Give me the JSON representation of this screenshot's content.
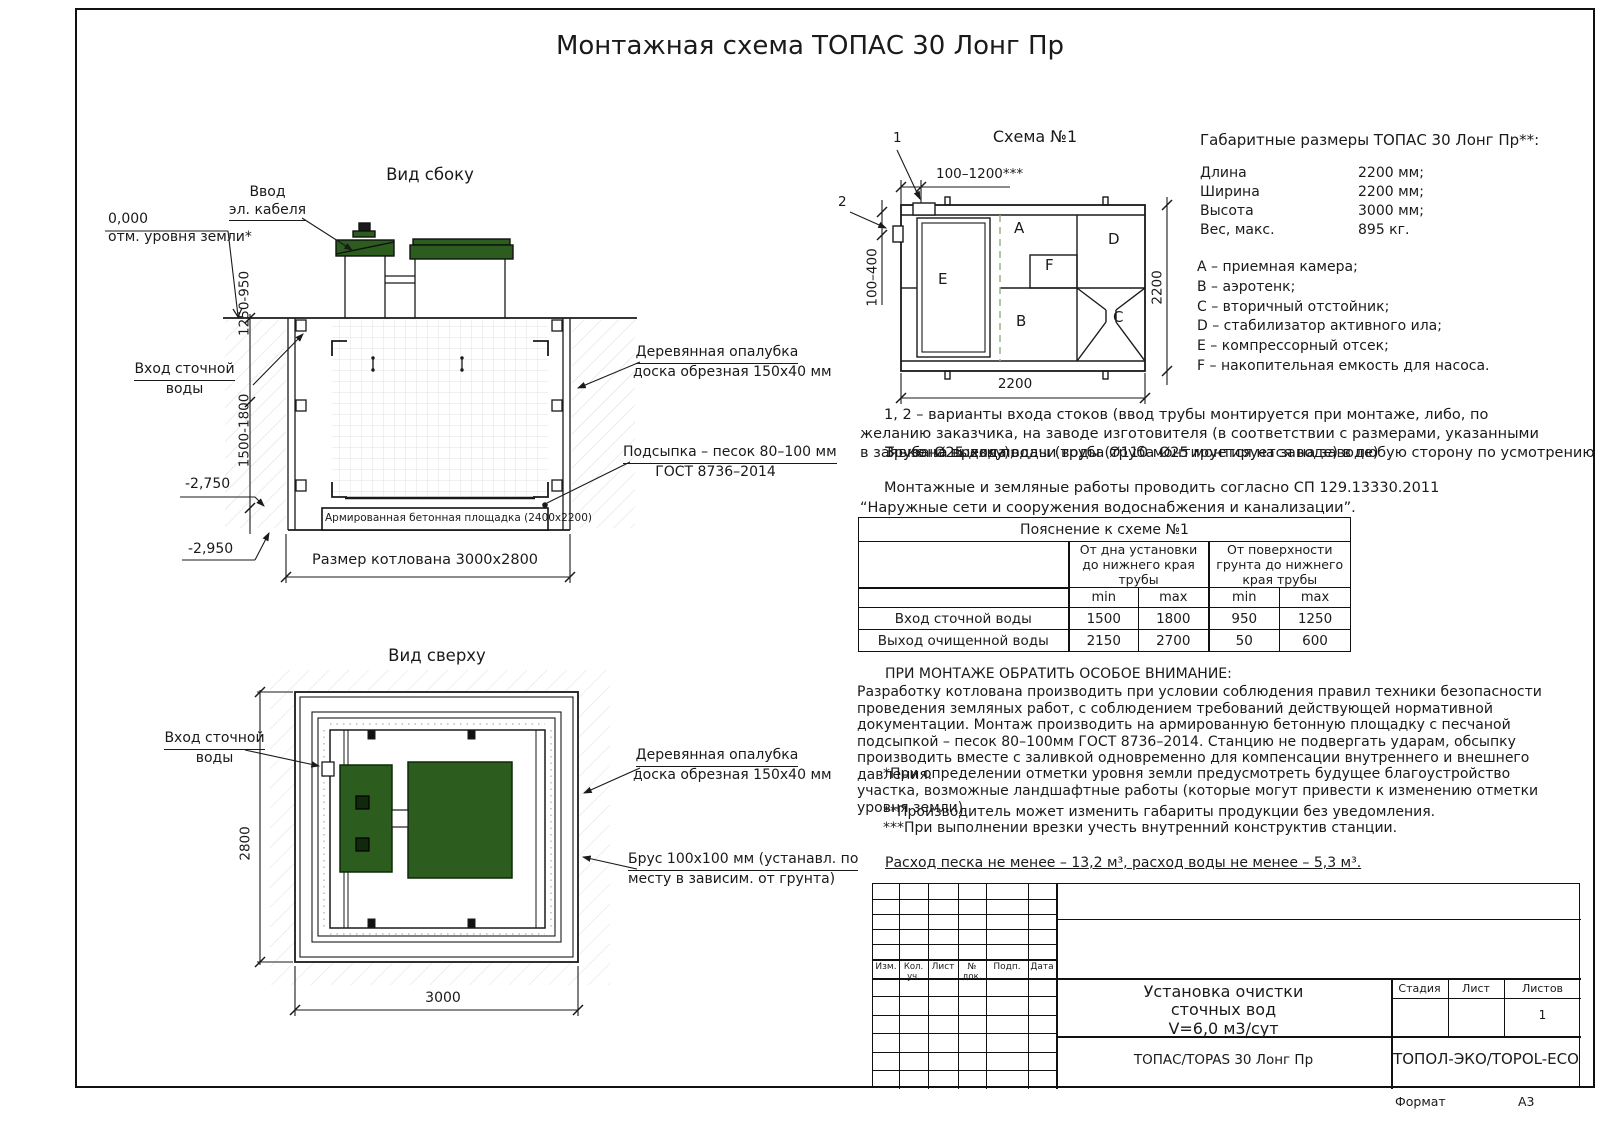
{
  "page": {
    "title": "Монтажная схема ТОПАС 30 Лонг Пр",
    "format_label": "Формат",
    "format_value": "А3"
  },
  "side_view": {
    "title": "Вид сбоку",
    "cable_1": "Ввод",
    "cable_2": "эл. кабеля",
    "zero": "0,000",
    "zero_sub": "отм. уровня земли*",
    "inlet_1": "Вход сточной",
    "inlet_2": "воды",
    "formwork_1": "Деревянная опалубка",
    "formwork_2": "доска обрезная 150х40 мм",
    "bedding_1": "Подсыпка – песок 80–100 мм",
    "bedding_2": "ГОСТ 8736–2014",
    "slab": "Армированная бетонная площадка (2400х2200)",
    "pit_size": "Размер котлована 3000х2800",
    "dim_upper": "1250-950",
    "dim_lower": "1500-1800",
    "level_1": "-2,750",
    "level_2": "-2,950"
  },
  "top_view": {
    "title": "Вид сверху",
    "inlet_1": "Вход сточной",
    "inlet_2": "воды",
    "formwork_1": "Деревянная опалубка",
    "formwork_2": "доска обрезная 150х40 мм",
    "beam_1": "Брус 100х100 мм (устанавл. по",
    "beam_2": "месту в зависим. от грунта)",
    "dim_width": "2800",
    "dim_length": "3000"
  },
  "schema": {
    "title": "Схема №1",
    "marker_1": "1",
    "marker_2": "2",
    "dim_top": "100–1200***",
    "dim_left": "100–400",
    "dim_bottom": "2200",
    "dim_right": "2200",
    "chamber_a": "A",
    "chamber_b": "B",
    "chamber_c": "C",
    "chamber_d": "D",
    "chamber_e": "E",
    "chamber_f": "F"
  },
  "overall": {
    "heading": "Габаритные размеры ТОПАС 30 Лонг Пр**:",
    "rows": [
      {
        "label": "Длина",
        "value": "2200 мм;"
      },
      {
        "label": "Ширина",
        "value": "2200 мм;"
      },
      {
        "label": "Высота",
        "value": "3000 мм;"
      },
      {
        "label": "Вес, макс.",
        "value": "895 кг."
      }
    ],
    "legend": [
      "A – приемная камера;",
      "B – аэротенк;",
      "C – вторичный отстойник;",
      "D – стабилизатор активного ила;",
      "E – компрессорный отсек;",
      "F – накопительная емкость для насоса."
    ]
  },
  "notes": {
    "variants": "1, 2 – варианты входа  стоков (ввод трубы монтируется при монтаже, либо, по желанию заказчика, на заводе изготовителя (в соответствии с размерами, указанными в заявке на врезку);",
    "overlap_a": "3 – зона выхода воды (труба Ø110 монтируется на заводе) в любую сторону по усмотрению заказчика.",
    "overlap_b": "Труба Ø25 для подачи воды (труба Ø25 монтируется на заводе)",
    "works": "Монтажные и земляные работы проводить согласно СП 129.13330.2011 “Наружные сети и сооружения водоснабжения и канализации”."
  },
  "expl_table": {
    "title": "Пояснение к схеме №1",
    "group_1": "От дна установки до нижнего края трубы",
    "group_2": "От поверхности грунта до нижнего края трубы",
    "min_1": "min",
    "max_1": "max",
    "min_2": "min",
    "max_2": "max",
    "rows": [
      {
        "label": "Вход сточной воды",
        "v": [
          "1500",
          "1800",
          "950",
          "1250"
        ]
      },
      {
        "label": "Выход очищенной воды",
        "v": [
          "2150",
          "2700",
          "50",
          "600"
        ]
      }
    ]
  },
  "warning": {
    "heading": "ПРИ МОНТАЖЕ ОБРАТИТЬ ОСОБОЕ ВНИМАНИЕ:",
    "body": "Разработку котлована производить при условии соблюдения правил техники безопасности проведения земляных работ, с соблюдением требований действующей нормативной документации.  Монтаж производить на армированную бетонную площадку с песчаной подсыпкой – песок 80–100мм ГОСТ 8736–2014. Станцию не подвергать ударам, обсыпку производить вместе с заливкой одновременно для компенсации внутреннего и внешнего давления.",
    "note_1": "*При определении отметки уровня земли предусмотреть будущее благоустройство участка, возможные ландшафтные работы (которые могут привести к изменению отметки уровня земли).",
    "note_2": "**Производитель может изменить габариты продукции без уведомления.",
    "note_3": "***При выполнении врезки учесть внутренний конструктив станции.",
    "consumption": "Расход песка не менее – 13,2 м³, расход воды не менее – 5,3 м³."
  },
  "titleblock": {
    "cols": [
      "Изм.",
      "Кол. уч.",
      "Лист",
      "№ док.",
      "Подп.",
      "Дата"
    ],
    "doc_title_1": "Установка очистки",
    "doc_title_2": "сточных вод",
    "doc_title_3": "V=6,0 м3/сут",
    "stage": "Стадия",
    "sheet": "Лист",
    "sheets": "Листов",
    "sheets_value": "1",
    "model": "ТОПАС/TOPAS 30 Лонг Пр",
    "company": "ТОПОЛ-ЭКО/TOPOL-ECO"
  },
  "colors": {
    "line": "#1a1a1a",
    "green": "#2c5c1e"
  }
}
